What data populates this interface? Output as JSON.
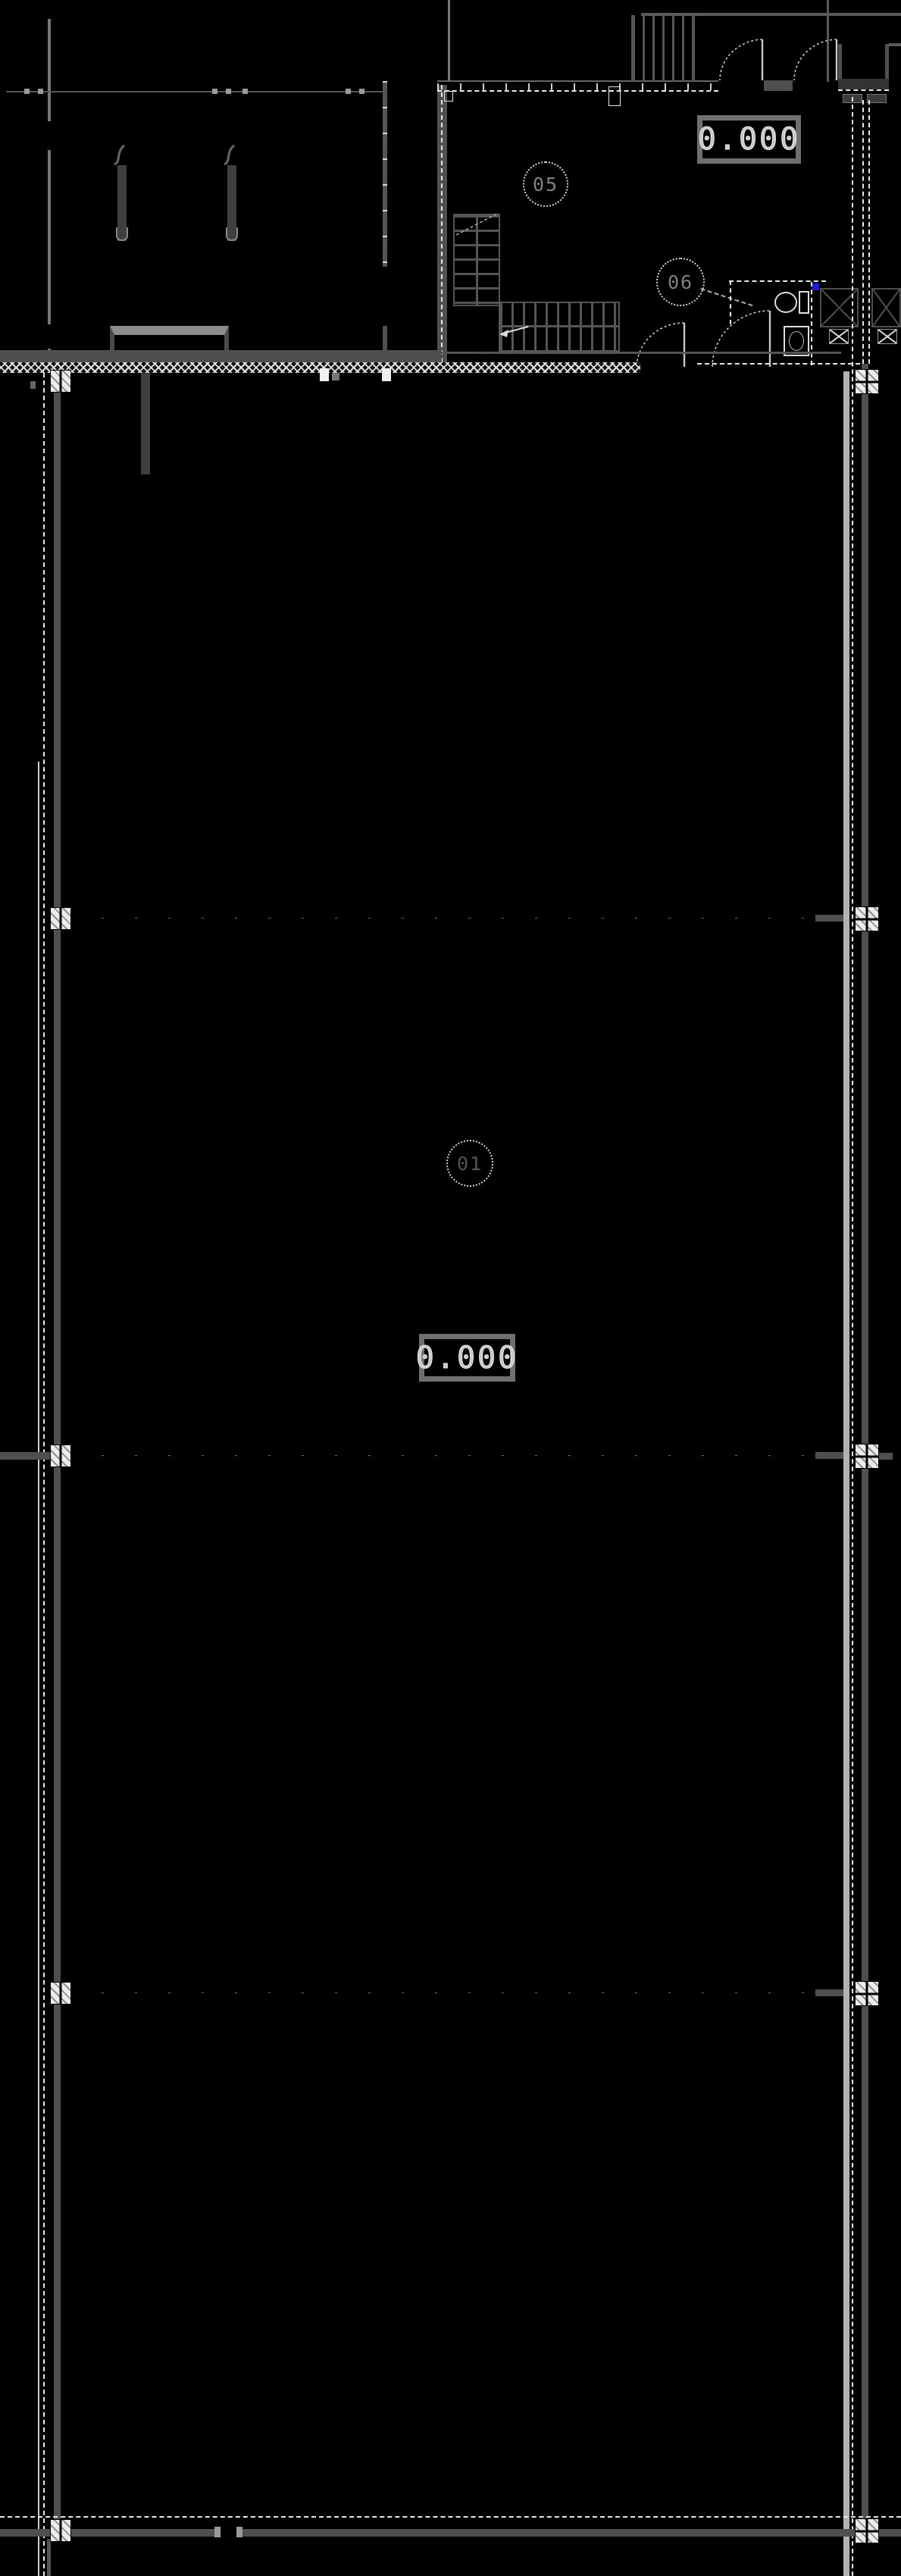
{
  "drawing": {
    "kind": "architectural-floor-plan-dark-cad",
    "elevation_markers": [
      {
        "value": "0.000"
      },
      {
        "value": "0.000"
      }
    ],
    "room_tags": [
      {
        "number": "05"
      },
      {
        "number": "06"
      },
      {
        "number": "01"
      }
    ],
    "colors": {
      "background": "#000000",
      "wall_gray": "#4f4f4f",
      "wall_light_gray": "#b2b2b2",
      "bright_line": "#e8e8e8",
      "hatch_white": "#e0e0e0",
      "plumbing_marker_blue": "#1e1ecc",
      "tag_text_gray": "#808080"
    }
  }
}
